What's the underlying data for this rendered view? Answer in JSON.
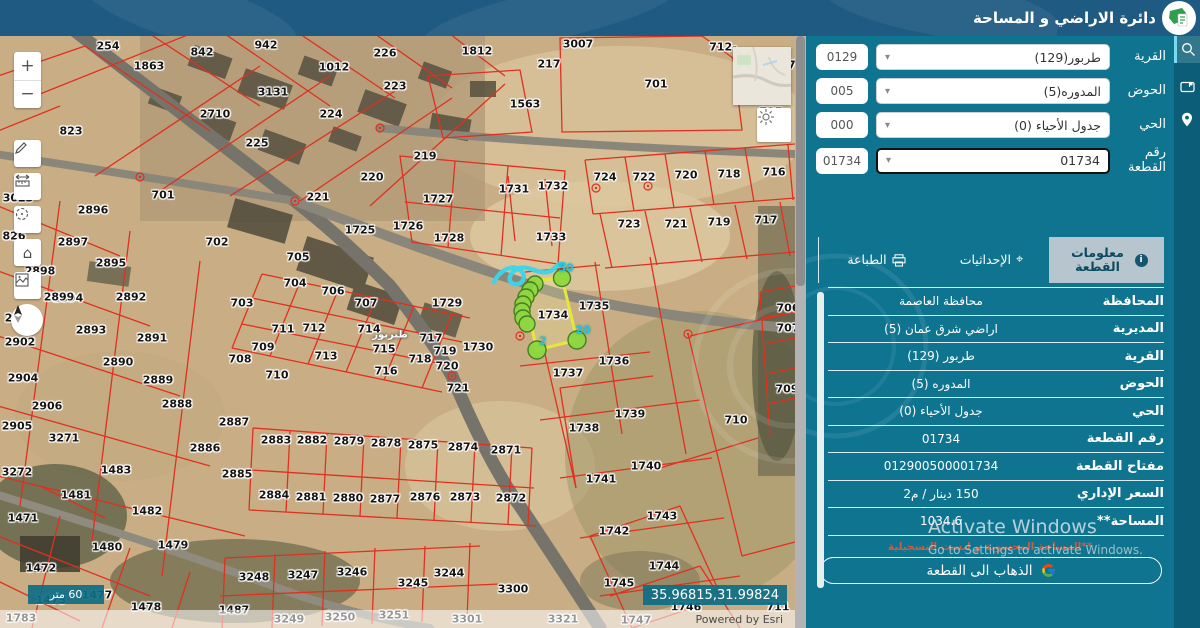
{
  "app": {
    "title": "دائرة الاراضي و المساحة"
  },
  "search_panel": {
    "fields": [
      {
        "label": "القرية",
        "value": "طربور(129)",
        "code": "0129"
      },
      {
        "label": "الحوض",
        "value": "المدوره(5)",
        "code": "005"
      },
      {
        "label": "الحي",
        "value": "جدول الأحياء (0)",
        "code": "000"
      },
      {
        "label": "رقم القطعة",
        "value": "01734",
        "code": "01734"
      }
    ],
    "tabs": [
      {
        "label": "معلومات القطعة",
        "active": true
      },
      {
        "label": "الإحداثيات",
        "active": false
      },
      {
        "label": "الطباعة",
        "active": false
      }
    ],
    "info_rows": [
      {
        "label": "المحافظة",
        "value": "محافظة العاصمة"
      },
      {
        "label": "المديرية",
        "value": "اراضي شرق عمان (5)"
      },
      {
        "label": "القرية",
        "value": "طربور (129)"
      },
      {
        "label": "الحوض",
        "value": "المدوره (5)"
      },
      {
        "label": "الحي",
        "value": "جدول الأحياء (0)"
      },
      {
        "label": "رقم القطعة",
        "value": "01734"
      },
      {
        "label": "مفتاح القطعة",
        "value": "012900500001734"
      },
      {
        "label": "السعر الإداري",
        "value": "150 دينار / م2"
      },
      {
        "label": "المساحة**",
        "value": "1034.6"
      }
    ],
    "footnote": "**المساحة المحسوبة و ليست التسجيلية",
    "goto_button": "الذهاب الى القطعة"
  },
  "map": {
    "scale_label": "60 متر",
    "coordinates": "35.96815,31.99824",
    "attribution": "Powered by Esri",
    "highlight_labels": [
      {
        "t": "50",
        "x": 566,
        "y": 232
      },
      {
        "t": "20",
        "x": 583,
        "y": 294
      },
      {
        "t": "2",
        "x": 543,
        "y": 305
      }
    ],
    "labels": [
      {
        "t": "254",
        "x": 108,
        "y": 10
      },
      {
        "t": "842",
        "x": 202,
        "y": 16
      },
      {
        "t": "942",
        "x": 266,
        "y": 9
      },
      {
        "t": "1812",
        "x": 477,
        "y": 15
      },
      {
        "t": "3007",
        "x": 578,
        "y": 8
      },
      {
        "t": "712-",
        "x": 723,
        "y": 11
      },
      {
        "t": "87",
        "x": 788,
        "y": 29
      },
      {
        "t": "226",
        "x": 385,
        "y": 17
      },
      {
        "t": "1863",
        "x": 149,
        "y": 30
      },
      {
        "t": "1012",
        "x": 334,
        "y": 31
      },
      {
        "t": "217",
        "x": 549,
        "y": 28
      },
      {
        "t": "223",
        "x": 395,
        "y": 50
      },
      {
        "t": "3131",
        "x": 273,
        "y": 56
      },
      {
        "t": "2710",
        "x": 215,
        "y": 78
      },
      {
        "t": "224",
        "x": 331,
        "y": 78
      },
      {
        "t": "701",
        "x": 656,
        "y": 48
      },
      {
        "t": "1563",
        "x": 525,
        "y": 68
      },
      {
        "t": "725",
        "x": 771,
        "y": 76
      },
      {
        "t": "823",
        "x": 71,
        "y": 95
      },
      {
        "t": "225",
        "x": 257,
        "y": 107
      },
      {
        "t": "219",
        "x": 425,
        "y": 120
      },
      {
        "t": "220",
        "x": 372,
        "y": 141
      },
      {
        "t": "221",
        "x": 318,
        "y": 161
      },
      {
        "t": "1731",
        "x": 514,
        "y": 153
      },
      {
        "t": "1732",
        "x": 553,
        "y": 150
      },
      {
        "t": "724",
        "x": 605,
        "y": 141
      },
      {
        "t": "722",
        "x": 644,
        "y": 141
      },
      {
        "t": "720",
        "x": 686,
        "y": 139
      },
      {
        "t": "718",
        "x": 729,
        "y": 138
      },
      {
        "t": "716",
        "x": 774,
        "y": 136
      },
      {
        "t": "701",
        "x": 163,
        "y": 159
      },
      {
        "t": "2896",
        "x": 93,
        "y": 174
      },
      {
        "t": "1725",
        "x": 360,
        "y": 194
      },
      {
        "t": "1726",
        "x": 408,
        "y": 190
      },
      {
        "t": "1727",
        "x": 438,
        "y": 163
      },
      {
        "t": "702",
        "x": 217,
        "y": 206
      },
      {
        "t": "2897",
        "x": 73,
        "y": 206
      },
      {
        "t": "1728",
        "x": 449,
        "y": 202
      },
      {
        "t": "1733",
        "x": 551,
        "y": 201
      },
      {
        "t": "723",
        "x": 629,
        "y": 188
      },
      {
        "t": "721",
        "x": 676,
        "y": 188
      },
      {
        "t": "719",
        "x": 719,
        "y": 186
      },
      {
        "t": "717",
        "x": 766,
        "y": 184
      },
      {
        "t": "2895",
        "x": 111,
        "y": 227
      },
      {
        "t": "705",
        "x": 298,
        "y": 221
      },
      {
        "t": "704",
        "x": 295,
        "y": 247
      },
      {
        "t": "706",
        "x": 333,
        "y": 255
      },
      {
        "t": "707",
        "x": 366,
        "y": 267
      },
      {
        "t": "2898",
        "x": 40,
        "y": 235
      },
      {
        "t": "2894",
        "x": 68,
        "y": 262
      },
      {
        "t": "2892",
        "x": 131,
        "y": 261
      },
      {
        "t": "703",
        "x": 242,
        "y": 267
      },
      {
        "t": "2901",
        "x": 20,
        "y": 282
      },
      {
        "t": "2902",
        "x": 20,
        "y": 306
      },
      {
        "t": "2893",
        "x": 91,
        "y": 294
      },
      {
        "t": "2891",
        "x": 152,
        "y": 302
      },
      {
        "t": "711",
        "x": 283,
        "y": 293
      },
      {
        "t": "712",
        "x": 314,
        "y": 292
      },
      {
        "t": "714",
        "x": 369,
        "y": 293
      },
      {
        "t": "717",
        "x": 431,
        "y": 302
      },
      {
        "t": "719",
        "x": 445,
        "y": 315
      },
      {
        "t": "1729",
        "x": 447,
        "y": 267
      },
      {
        "t": "1734",
        "x": 553,
        "y": 279
      },
      {
        "t": "1735",
        "x": 594,
        "y": 270
      },
      {
        "t": "706",
        "x": 788,
        "y": 272
      },
      {
        "t": "707",
        "x": 788,
        "y": 292
      },
      {
        "t": "709",
        "x": 263,
        "y": 311
      },
      {
        "t": "715",
        "x": 384,
        "y": 313
      },
      {
        "t": "708",
        "x": 240,
        "y": 323
      },
      {
        "t": "1730",
        "x": 478,
        "y": 311
      },
      {
        "t": "718",
        "x": 420,
        "y": 323
      },
      {
        "t": "720",
        "x": 447,
        "y": 330
      },
      {
        "t": "716",
        "x": 386,
        "y": 335
      },
      {
        "t": "713",
        "x": 326,
        "y": 320
      },
      {
        "t": "2890",
        "x": 118,
        "y": 326
      },
      {
        "t": "2889",
        "x": 158,
        "y": 344
      },
      {
        "t": "1736",
        "x": 614,
        "y": 325
      },
      {
        "t": "1737",
        "x": 568,
        "y": 337
      },
      {
        "t": "2888",
        "x": 177,
        "y": 368
      },
      {
        "t": "2887",
        "x": 234,
        "y": 386
      },
      {
        "t": "2904",
        "x": 23,
        "y": 342
      },
      {
        "t": "2906",
        "x": 47,
        "y": 370
      },
      {
        "t": "2905",
        "x": 17,
        "y": 390
      },
      {
        "t": "3271",
        "x": 64,
        "y": 402
      },
      {
        "t": "2886",
        "x": 205,
        "y": 412
      },
      {
        "t": "2883",
        "x": 276,
        "y": 404
      },
      {
        "t": "2882",
        "x": 312,
        "y": 404
      },
      {
        "t": "2879",
        "x": 349,
        "y": 405
      },
      {
        "t": "2878",
        "x": 386,
        "y": 407
      },
      {
        "t": "2875",
        "x": 423,
        "y": 409
      },
      {
        "t": "2874",
        "x": 463,
        "y": 411
      },
      {
        "t": "2871",
        "x": 506,
        "y": 414
      },
      {
        "t": "3272",
        "x": 17,
        "y": 436
      },
      {
        "t": "1483",
        "x": 116,
        "y": 434
      },
      {
        "t": "2885",
        "x": 237,
        "y": 438
      },
      {
        "t": "1739",
        "x": 630,
        "y": 378
      },
      {
        "t": "710",
        "x": 736,
        "y": 384
      },
      {
        "t": "1738",
        "x": 584,
        "y": 392
      },
      {
        "t": "709",
        "x": 787,
        "y": 353
      },
      {
        "t": "721",
        "x": 458,
        "y": 352
      },
      {
        "t": "710",
        "x": 277,
        "y": 339
      },
      {
        "t": "1740",
        "x": 646,
        "y": 430
      },
      {
        "t": "1741",
        "x": 601,
        "y": 443
      },
      {
        "t": "1481",
        "x": 76,
        "y": 459
      },
      {
        "t": "2884",
        "x": 274,
        "y": 459
      },
      {
        "t": "2881",
        "x": 311,
        "y": 461
      },
      {
        "t": "2880",
        "x": 348,
        "y": 462
      },
      {
        "t": "2877",
        "x": 385,
        "y": 463
      },
      {
        "t": "2876",
        "x": 425,
        "y": 461
      },
      {
        "t": "2873",
        "x": 465,
        "y": 461
      },
      {
        "t": "2872",
        "x": 511,
        "y": 462
      },
      {
        "t": "1482",
        "x": 147,
        "y": 475
      },
      {
        "t": "1743",
        "x": 662,
        "y": 480
      },
      {
        "t": "1742",
        "x": 614,
        "y": 495
      },
      {
        "t": "1471",
        "x": 23,
        "y": 482
      },
      {
        "t": "1480",
        "x": 107,
        "y": 511
      },
      {
        "t": "1479",
        "x": 173,
        "y": 509
      },
      {
        "t": "3248",
        "x": 254,
        "y": 541
      },
      {
        "t": "3247",
        "x": 303,
        "y": 539
      },
      {
        "t": "3246",
        "x": 352,
        "y": 536
      },
      {
        "t": "3245",
        "x": 413,
        "y": 547
      },
      {
        "t": "3244",
        "x": 449,
        "y": 537
      },
      {
        "t": "3300",
        "x": 513,
        "y": 553
      },
      {
        "t": "1745",
        "x": 619,
        "y": 547
      },
      {
        "t": "1744",
        "x": 664,
        "y": 530
      },
      {
        "t": "1472",
        "x": 41,
        "y": 532
      },
      {
        "t": "1746",
        "x": 686,
        "y": 571
      },
      {
        "t": "711",
        "x": 778,
        "y": 571
      },
      {
        "t": "1747",
        "x": 636,
        "y": 584
      },
      {
        "t": "1783",
        "x": 21,
        "y": 582
      },
      {
        "t": "1478",
        "x": 146,
        "y": 571
      },
      {
        "t": "1487",
        "x": 234,
        "y": 574
      },
      {
        "t": "3249",
        "x": 289,
        "y": 583
      },
      {
        "t": "3250",
        "x": 340,
        "y": 581
      },
      {
        "t": "3251",
        "x": 394,
        "y": 579
      },
      {
        "t": "3301",
        "x": 467,
        "y": 583
      },
      {
        "t": "3321",
        "x": 563,
        "y": 583
      },
      {
        "t": "1473",
        "x": 51,
        "y": 564
      },
      {
        "t": "1477",
        "x": 97,
        "y": 559
      },
      {
        "t": "826",
        "x": 14,
        "y": 200
      },
      {
        "t": "3023",
        "x": 18,
        "y": 162
      },
      {
        "t": "2899",
        "x": 59,
        "y": 261
      },
      {
        "t": "طبربور",
        "x": 390,
        "y": 299,
        "place": true
      }
    ]
  },
  "watermark": {
    "line1": "Activate Windows",
    "line2": "Go to Settings to activate Windows."
  },
  "colors": {
    "accent": "#0f7490",
    "topbar": "#1e5a82",
    "parcel_line": "#e03020",
    "highlight": "#e6e63c"
  }
}
